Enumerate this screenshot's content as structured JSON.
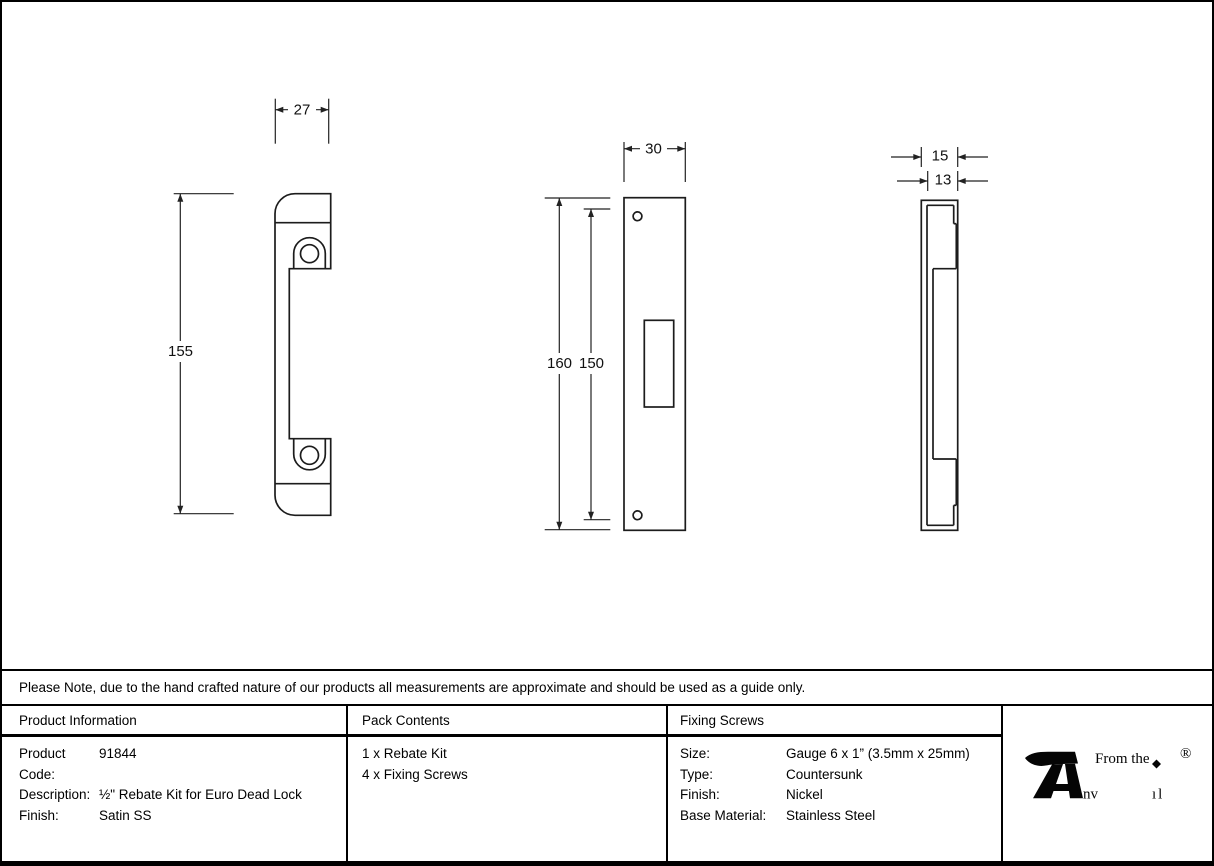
{
  "note": "Please Note, due to the hand crafted nature of our products all measurements are approximate and should be used as a guide only.",
  "drawings": {
    "side_profile_view": {
      "width_dim": "27",
      "height_dim": "155"
    },
    "face_view": {
      "width_dim": "30",
      "outer_height_dim": "160",
      "inner_height_dim": "150"
    },
    "edge_view": {
      "outer_depth_dim": "15",
      "inner_depth_dim": "13"
    }
  },
  "table": {
    "product_information": {
      "header": "Product Information",
      "rows": [
        {
          "label": "Product Code:",
          "value": "91844"
        },
        {
          "label": "Description:",
          "value": "½\" Rebate Kit for Euro Dead Lock"
        },
        {
          "label": "Finish:",
          "value": "Satin SS"
        }
      ]
    },
    "pack_contents": {
      "header": "Pack Contents",
      "items": [
        "1 x Rebate Kit",
        "4 x Fixing Screws"
      ]
    },
    "fixing_screws": {
      "header": "Fixing Screws",
      "rows": [
        {
          "label": "Size:",
          "value": "Gauge 6 x 1” (3.5mm x 25mm)"
        },
        {
          "label": "Type:",
          "value": "Countersunk"
        },
        {
          "label": "Finish:",
          "value": "Nickel"
        },
        {
          "label": "Base Material:",
          "value": "Stainless Steel"
        }
      ]
    }
  },
  "logo": {
    "prefix": "From the",
    "brand": "Anvil",
    "brand_tail_1": "nv",
    "brand_tail_2": "ıl",
    "registered": "®"
  }
}
